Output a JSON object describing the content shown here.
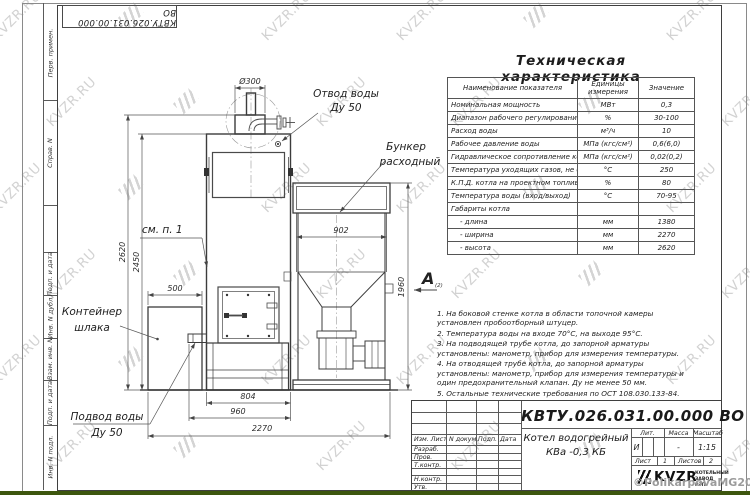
{
  "watermark": {
    "text": "KVZR.RU"
  },
  "copyright": "©PolikarpovaMG2021",
  "stamp_top": "КВТУ.026.031.00.000 ВО",
  "side_labels": [
    "Перв. примен.",
    "Справ. N",
    "Подп. и дата",
    "Инв. N дубл.",
    "Взам. инв. N",
    "Подп. и дата",
    "Инв. N подл."
  ],
  "table": {
    "title": "Техническая характеристика",
    "headers": [
      "Наименование показателя",
      "Единицы измерения",
      "Значение"
    ],
    "rows": [
      [
        "Номинальная мощность",
        "МВт",
        "0,3"
      ],
      [
        "Диапазон рабочего регулирования",
        "%",
        "30-100"
      ],
      [
        "Расход воды",
        "м³/ч",
        "10"
      ],
      [
        "Рабочее давление воды",
        "МПа (кгс/см²)",
        "0,6(6,0)"
      ],
      [
        "Гидравлическое сопротивление котла",
        "МПа (кгс/см²)",
        "0,02(0,2)"
      ],
      [
        "Температура уходящих газов, не более",
        "°С",
        "250"
      ],
      [
        "К.П.Д. котла на проектном топливе",
        "%",
        "80"
      ],
      [
        "Температура воды (вход/выход)",
        "°С",
        "70-95"
      ],
      [
        "Габариты котла",
        "",
        ""
      ],
      [
        "- длина",
        "мм",
        "1380"
      ],
      [
        "- ширина",
        "мм",
        "2270"
      ],
      [
        "- высота",
        "мм",
        "2620"
      ]
    ]
  },
  "notes": [
    "1. На боковой стенке котла в области топочной камеры установлен пробоотборный штуцер.",
    "2. Температура воды на входе 70°С, на выходе 95°С.",
    "3. На подводящей трубе котла, до запорной арматуры установлены: манометр, прибор для измерения температуры.",
    "4. На отводящей трубе котла, до запорной арматуры установлены: манометр, прибор для измерения температуры и один предохранительный клапан. Ду не менее 50 мм.",
    "5. Остальные технические требования по ОСТ 108.030.133-84."
  ],
  "drawing": {
    "dims": {
      "d300": "Ø300",
      "d902": "902",
      "d2620": "2620",
      "d2450": "2450",
      "d500": "500",
      "d1960": "1960",
      "d804": "804",
      "d960": "960",
      "d2270": "2270"
    },
    "labels": {
      "otvod1": "Отвод воды",
      "otvod2": "Ду 50",
      "bunker1": "Бункер",
      "bunker2": "расходный",
      "smp": "см. п. 1",
      "kont1": "Контейнер",
      "kont2": "шлака",
      "podvod1": "Подвод воды",
      "podvod2": "Ду 50",
      "view_a": "A",
      "view_a_sub": "(2)"
    }
  },
  "title_block": {
    "doc_number": "КВТУ.026.031.00.000  ВО",
    "product_name1": "Котел водогрейный",
    "product_name2": "КВа -0,3  КБ",
    "col_headers": [
      "Изм. Лист",
      "N докум.",
      "Подп.",
      "Дата"
    ],
    "row_labels": [
      "Разраб.",
      "Пров.",
      "Т.контр.",
      "Н.контр.",
      "Утв."
    ],
    "lit_header": "Лит.",
    "mass_header": "Масса",
    "scale_header": "Масштаб",
    "lit_value": "И",
    "mass_value": "-",
    "scale_value": "1:15",
    "sheet_label": "Лист",
    "sheet_value": "1",
    "sheets_label": "Листов",
    "sheets_value": "2",
    "logo_text": "KVZR",
    "company1": "КОТЕЛЬНЫЙ",
    "company2": "ЗАВОД РЭП"
  }
}
